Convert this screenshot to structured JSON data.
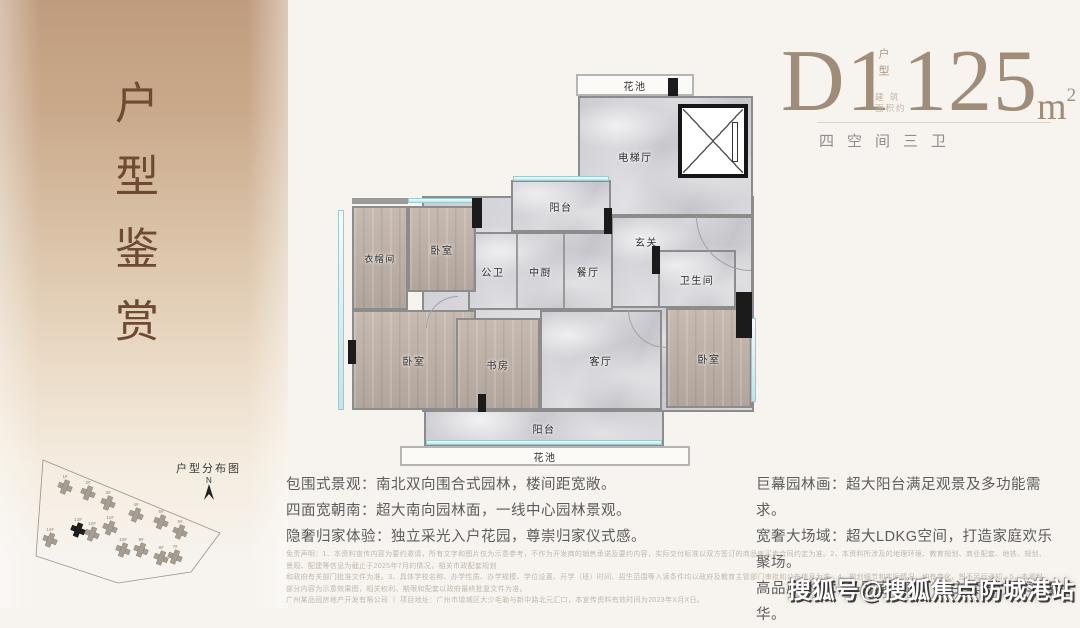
{
  "sidebar": {
    "title": "户型鉴赏"
  },
  "header": {
    "plan_code": "D1",
    "plan_code_label": "户型",
    "area_prefix_line1": "建 筑",
    "area_prefix_line2": "面积约",
    "area_value": "125",
    "area_unit": "m",
    "area_unit_sup": "2",
    "subtitle": "四空间三卫"
  },
  "floor_plan": {
    "labels": {
      "flower_top": "花池",
      "elevator_hall": "电梯厅",
      "balcony_top": "阳台",
      "entry": "玄关",
      "bath": "卫生间",
      "public_bath": "公卫",
      "kitchen": "中厨",
      "dining": "餐厅",
      "bedroom_tl": "卧室",
      "cloak": "衣帽间",
      "bedroom_bl": "卧室",
      "study": "书房",
      "living": "客厅",
      "bedroom_r": "卧室",
      "balcony_bottom": "阳台",
      "flower_bottom": "花池"
    }
  },
  "features": {
    "left": [
      "包围式景观：南北双向围合式园林，楼间距宽敞。",
      "四面宽朝南：超大南向园林面，一线中心园林景观。",
      "隐奢归家体验：独立采光入户花园，尊崇归家仪式感。"
    ],
    "right": [
      "巨幕园林画：超大阳台满足观景及多功能需求。",
      "宽奢大场域：超大LDKG空间，打造家庭欢乐聚场。",
      "高品质卧室：多卧室朝南，双主套设计尽享奢华。"
    ]
  },
  "disclaimer": {
    "lines": [
      "免责声明：1、本资料宣传内容为要约邀请，所有文字和图片仅为示意参考，不作为开发商的销售承诺及要约内容，实际交付标准以双方签订的商品房买卖合同约定为准。2、本资料所涉及的地理环境、教育规划、商业配套、地铁、规划、景观、配建等信息为截止于2025年7月的情况，相关市政配套规划",
      "和政府有关部门批准文件为准。3、具体学校名称、办学性质、办学规模、学位设置、开学（班）时间、招生范围等入读条件均以政府及教育主管部门审批和公布信息为准。4、规划细节和实际情况、如有变化、恕不另行通知。5、本资料部分内容为示意效果图，相关权利、期限和配套以政府最终批复文件为准。",
      "广州某品冠房地产开发有限公司 丨 项目地址：广州市增城区大少毛勒与新中路北元汇口，本宣传资料有效时间为2023年X月X日。"
    ]
  },
  "site_plan": {
    "title": "户型分布图",
    "compass": "N",
    "boundary": "15,22 192,95 163,134 90,145 8,118",
    "buildings": [
      {
        "x": 37,
        "y": 49,
        "label": "1#",
        "highlight": false
      },
      {
        "x": 60,
        "y": 55,
        "label": "2#",
        "highlight": false
      },
      {
        "x": 80,
        "y": 65,
        "label": "3#",
        "highlight": false
      },
      {
        "x": 108,
        "y": 77,
        "label": "4#",
        "highlight": false
      },
      {
        "x": 133,
        "y": 84,
        "label": "5#",
        "highlight": false
      },
      {
        "x": 152,
        "y": 94,
        "label": "6#",
        "highlight": false
      },
      {
        "x": 22,
        "y": 102,
        "label": "14#",
        "highlight": false
      },
      {
        "x": 50,
        "y": 92,
        "label": "13#",
        "highlight": true
      },
      {
        "x": 64,
        "y": 96,
        "label": "12#",
        "highlight": false
      },
      {
        "x": 82,
        "y": 90,
        "label": "11#",
        "highlight": false
      },
      {
        "x": 95,
        "y": 112,
        "label": "10#",
        "highlight": false
      },
      {
        "x": 113,
        "y": 112,
        "label": "9#",
        "highlight": false
      },
      {
        "x": 133,
        "y": 120,
        "label": "8#",
        "highlight": false
      },
      {
        "x": 147,
        "y": 119,
        "label": "7#",
        "highlight": false
      }
    ]
  },
  "watermark": {
    "text": "搜狐号@搜狐焦点防城港站"
  },
  "colors": {
    "sidebar_top": "#c09c7e",
    "title_brown": "#6e4a33",
    "header_taupe": "#9f8d79",
    "wall_gray": "#8c8c8c",
    "window_cyan": "#bfe6ea"
  }
}
